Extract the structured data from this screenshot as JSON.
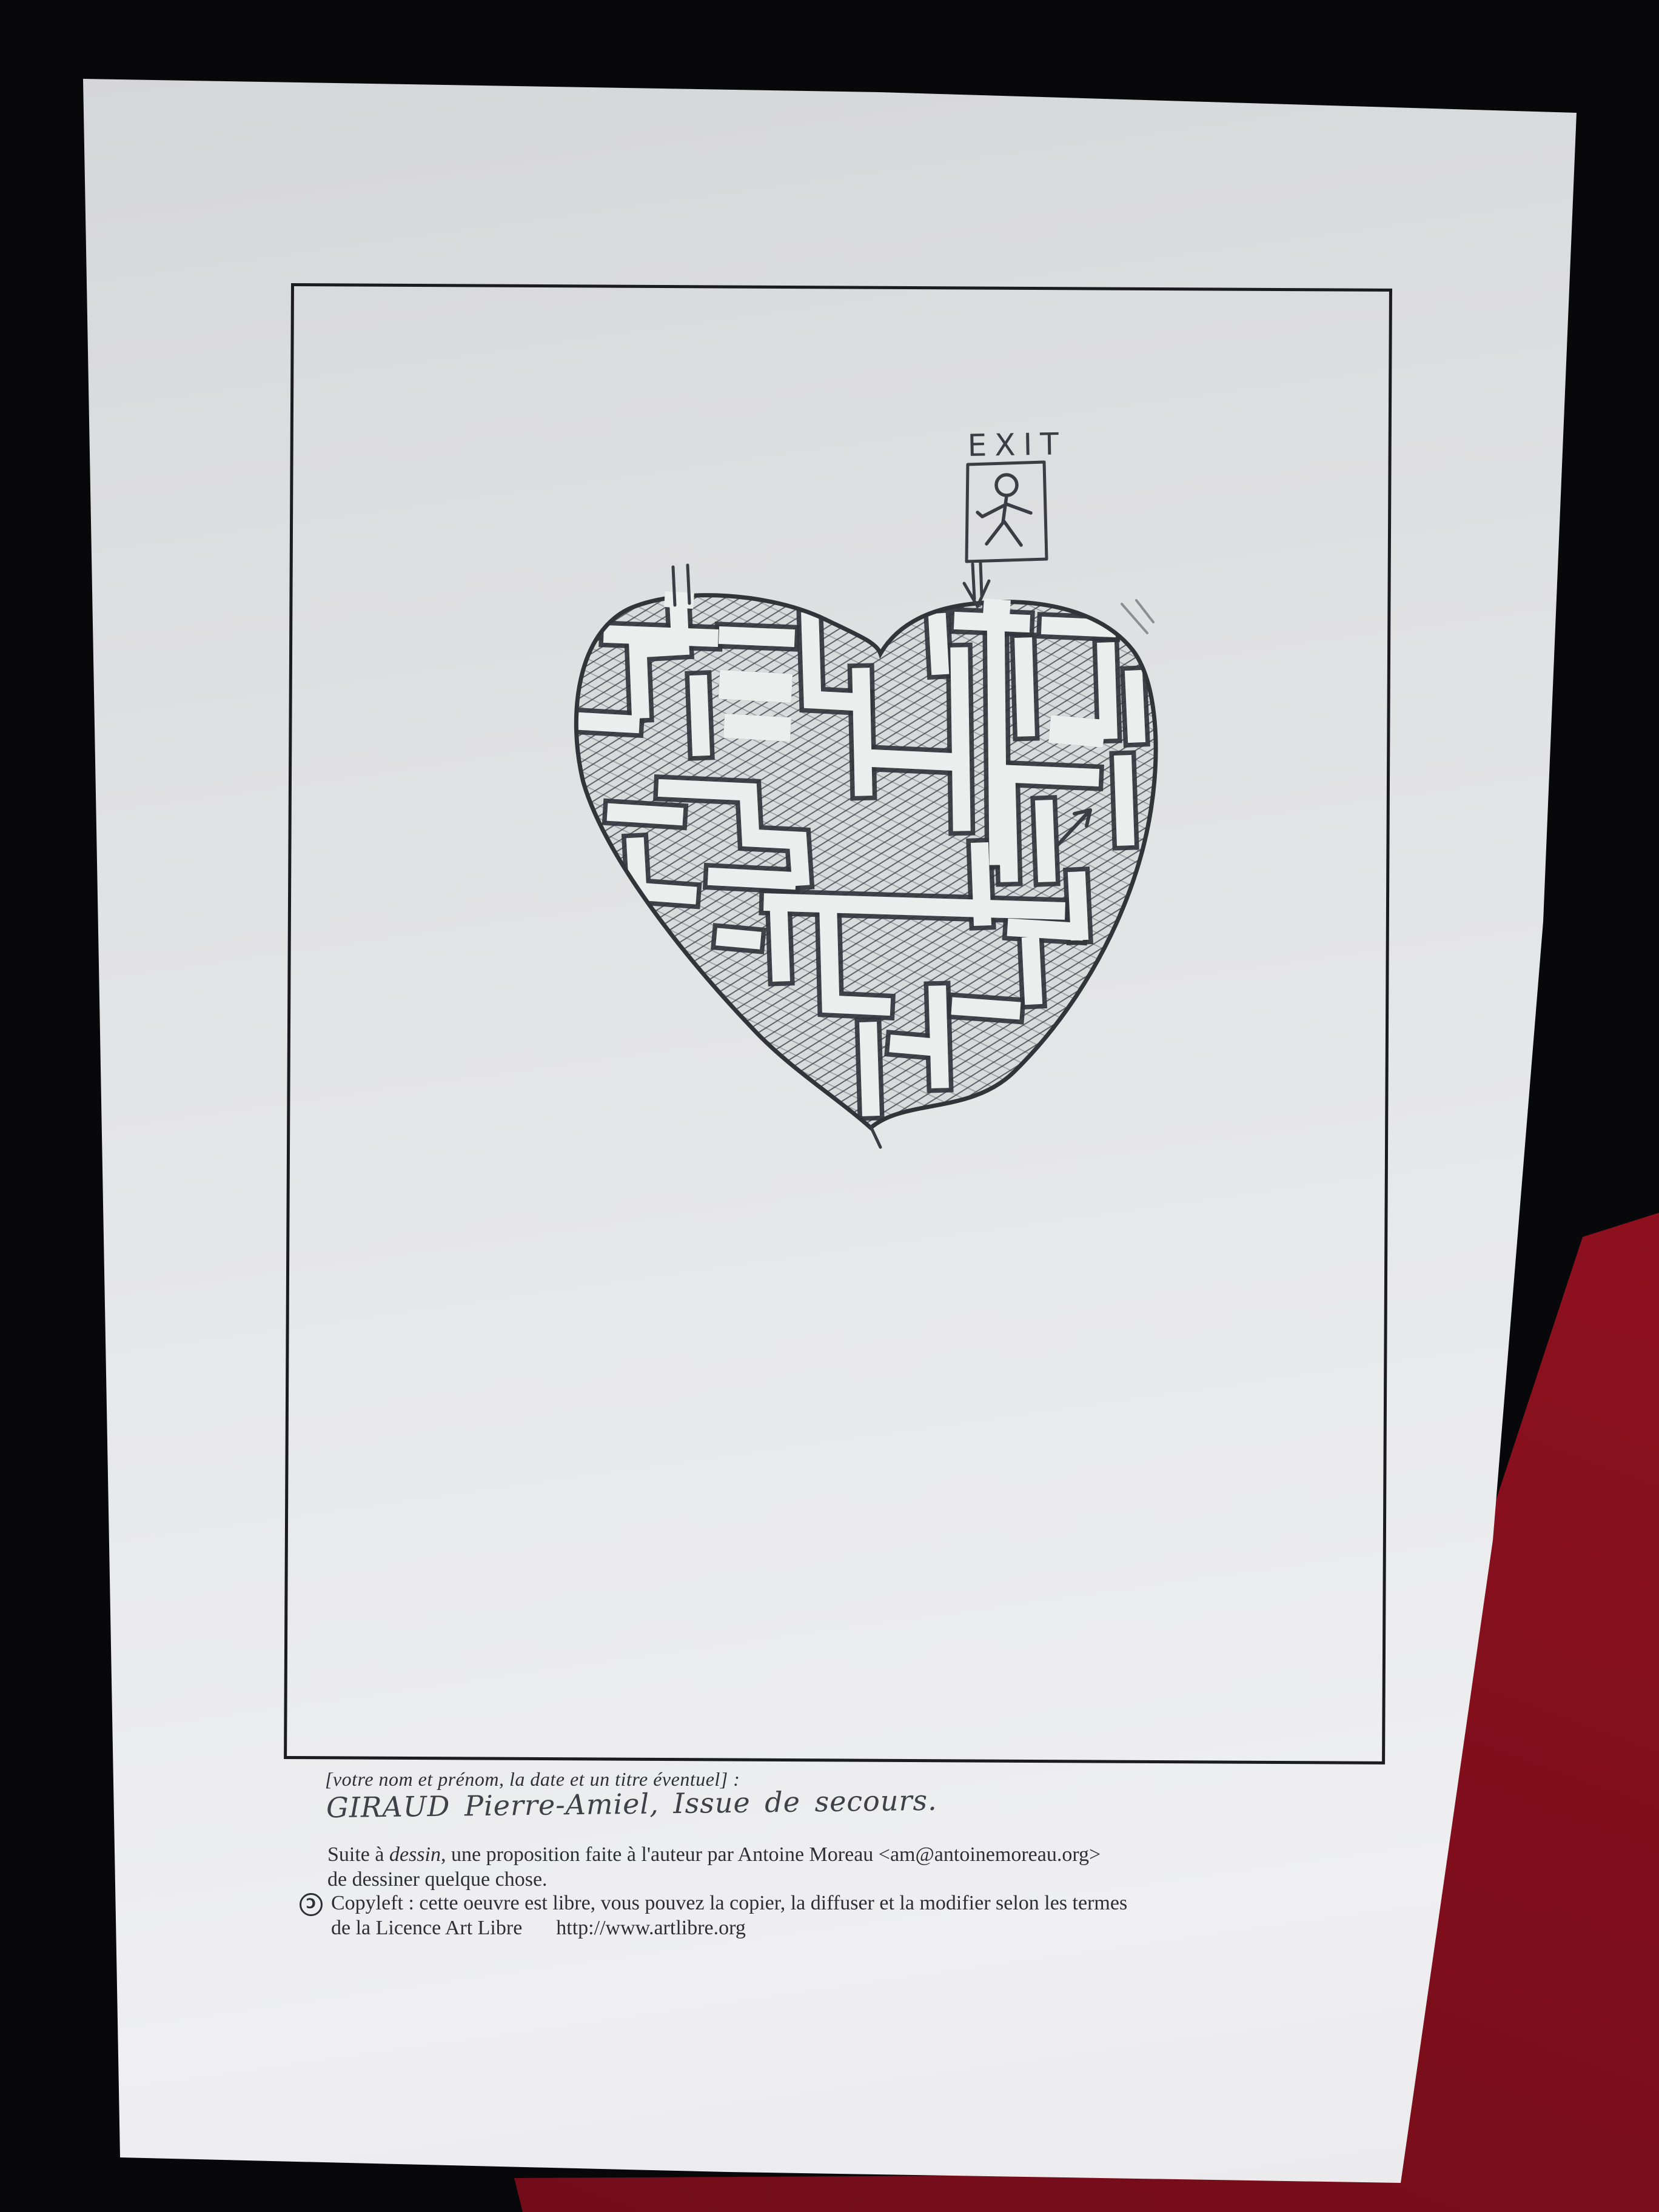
{
  "colors": {
    "background": "#08080a",
    "fabric": "#8d101f",
    "fabric-light": "#a31424",
    "fabric-dark": "#6e0c18",
    "paper": "#e6e7e9",
    "frame-ink": "#1b1b20",
    "pencil": "#3c3c44",
    "text-ink": "#2e2e34"
  },
  "drawing": {
    "exit_label": "EXIT"
  },
  "caption": {
    "placeholder_line": "[votre nom et prénom, la date et un titre éventuel] :",
    "handwritten_line": "GIRAUD Pierre-Amiel, Issue de secours.",
    "credit_prefix": "Suite à ",
    "credit_italic_word": "dessin",
    "credit_rest": ", une proposition faite à l'auteur par Antoine Moreau <am@antoinemoreau.org>",
    "credit_line2": "de dessiner quelque chose.",
    "copyleft_symbol": "Ɔ",
    "copyleft_line1": "Copyleft : cette oeuvre est libre, vous pouvez la copier, la diffuser et la modifier selon les termes",
    "copyleft_line2": "de la Licence Art Libre",
    "license_url": "http://www.artlibre.org"
  }
}
